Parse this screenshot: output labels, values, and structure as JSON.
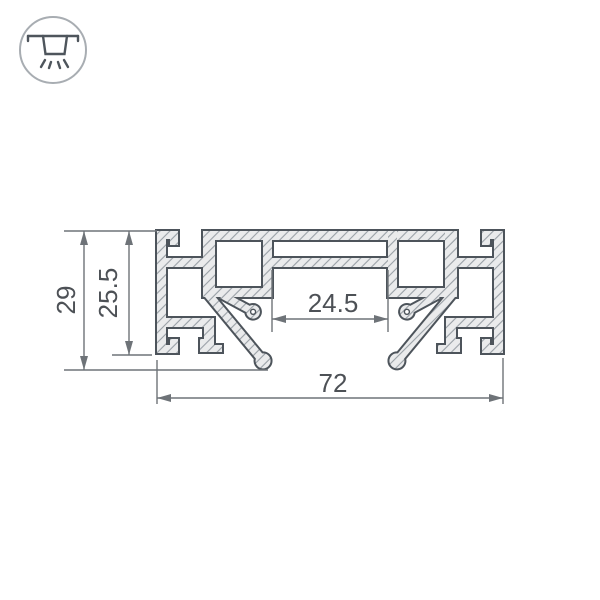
{
  "page": {
    "background": "#ffffff"
  },
  "icon": {
    "name": "recessed-ceiling-light",
    "description": "ceiling-mounted light fixture with downward light rays inside a circle"
  },
  "drawing": {
    "subject": "aluminum mounting profile cross-section",
    "style": {
      "outline_color": "#4d545b",
      "fill_color": "#eaebec",
      "hatch_color": "#99a0a6",
      "dimension_color": "#6e7378",
      "text_color": "#4d5156"
    },
    "dimensions": {
      "total_width": {
        "value": "72",
        "orientation": "horizontal"
      },
      "total_height": {
        "value": "29",
        "orientation": "vertical"
      },
      "body_height": {
        "value": "25.5",
        "orientation": "vertical"
      },
      "channel_width": {
        "value": "24.5",
        "orientation": "horizontal"
      }
    }
  }
}
